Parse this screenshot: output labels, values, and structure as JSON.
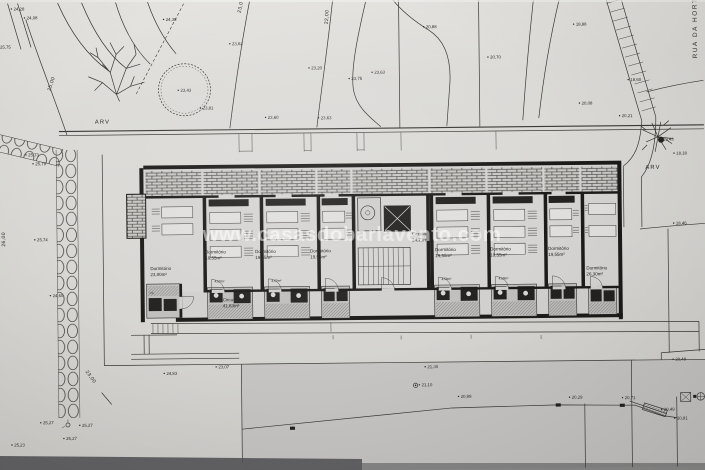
{
  "watermark": {
    "text": "www.casasdobarlavento.com"
  },
  "street": {
    "name": "RUA DA HORTINHA"
  },
  "trees": {
    "left_label": "ARV",
    "right_label": "ARV"
  },
  "colors": {
    "paper": "#dbdad7",
    "road": "#c6c5c3",
    "ink": "#3a3936",
    "wall": "#1c1b19",
    "watermark": "#ffffff"
  },
  "plan": {
    "rooms": [
      {
        "name": "Dormitório",
        "area": "23,80m²",
        "x": 150,
        "y": 268
      },
      {
        "name": "Dormitório",
        "area": "19,55m²",
        "x": 205,
        "y": 252
      },
      {
        "name": "Dormitório",
        "area": "19,55m²",
        "x": 255,
        "y": 252
      },
      {
        "name": "Dormitório",
        "area": "19,55m²",
        "x": 310,
        "y": 252
      },
      {
        "name": "Dormitório",
        "area": "19,55m²",
        "x": 435,
        "y": 252
      },
      {
        "name": "Dormitório",
        "area": "19,55m²",
        "x": 490,
        "y": 252
      },
      {
        "name": "Dormitório",
        "area": "19,55m²",
        "x": 548,
        "y": 252
      },
      {
        "name": "Dormitório",
        "area": "26,30m²",
        "x": 586,
        "y": 272
      },
      {
        "name": "Circulação",
        "area": "41,63m²",
        "x": 222,
        "y": 300
      },
      {
        "name": "Circulação",
        "area": "24,21m²",
        "x": 412,
        "y": 236
      }
    ],
    "bath_labels": [
      {
        "text": "4,50m²",
        "x": 214,
        "y": 281
      },
      {
        "text": "4,50m²",
        "x": 271,
        "y": 281
      },
      {
        "text": "4,50m²",
        "x": 441,
        "y": 281
      },
      {
        "text": "4,50m²",
        "x": 498,
        "y": 281
      },
      {
        "text": "I.S.",
        "x": 149,
        "y": 292
      }
    ],
    "spot_elevations": [
      {
        "text": "24,28",
        "x": 16,
        "y": 7
      },
      {
        "text": "24,08",
        "x": 29,
        "y": 16
      },
      {
        "text": "25,75",
        "x": 2,
        "y": 45
      },
      {
        "text": "24,38",
        "x": 168,
        "y": 19
      },
      {
        "text": "23,62",
        "x": 234,
        "y": 44
      },
      {
        "text": "23,43",
        "x": 182,
        "y": 90
      },
      {
        "text": "23,81",
        "x": 204,
        "y": 108
      },
      {
        "text": "23,60",
        "x": 269,
        "y": 118
      },
      {
        "text": "23,63",
        "x": 322,
        "y": 119
      },
      {
        "text": "23,20",
        "x": 313,
        "y": 69
      },
      {
        "text": "23,75",
        "x": 353,
        "y": 80
      },
      {
        "text": "23,63",
        "x": 376,
        "y": 74
      },
      {
        "text": "20,88",
        "x": 428,
        "y": 29
      },
      {
        "text": "18,88",
        "x": 578,
        "y": 28
      },
      {
        "text": "20,70",
        "x": 492,
        "y": 60
      },
      {
        "text": "20,08",
        "x": 583,
        "y": 107
      },
      {
        "text": "18,60",
        "x": 632,
        "y": 84
      },
      {
        "text": "20,21",
        "x": 623,
        "y": 120
      },
      {
        "text": "19,43",
        "x": 664,
        "y": 144
      },
      {
        "text": "18,18",
        "x": 677,
        "y": 158
      },
      {
        "text": "18,46",
        "x": 676,
        "y": 228
      },
      {
        "text": "25,73",
        "x": 29,
        "y": 153
      },
      {
        "text": "25,79",
        "x": 36,
        "y": 162
      },
      {
        "text": "25,74",
        "x": 37,
        "y": 238
      },
      {
        "text": "24,60",
        "x": 52,
        "y": 294
      },
      {
        "text": "24,83",
        "x": 165,
        "y": 373
      },
      {
        "text": "23,07",
        "x": 217,
        "y": 367
      },
      {
        "text": "21,30",
        "x": 426,
        "y": 369
      },
      {
        "text": "21,10",
        "x": 420,
        "y": 387
      },
      {
        "text": "20,98",
        "x": 459,
        "y": 399
      },
      {
        "text": "20,29",
        "x": 570,
        "y": 401
      },
      {
        "text": "20,71",
        "x": 623,
        "y": 402
      },
      {
        "text": "20,48",
        "x": 674,
        "y": 364
      },
      {
        "text": "20,49",
        "x": 662,
        "y": 414
      },
      {
        "text": "20,91",
        "x": 675,
        "y": 423
      },
      {
        "text": "25,27",
        "x": 41,
        "y": 421
      },
      {
        "text": "25,27",
        "x": 80,
        "y": 424
      },
      {
        "text": "25,27",
        "x": 64,
        "y": 437
      },
      {
        "text": "25,23",
        "x": 12,
        "y": 443
      }
    ],
    "contour_labels": [
      {
        "text": "25,00",
        "x": 52,
        "y": 88,
        "rot": -72
      },
      {
        "text": "23,0",
        "x": 243,
        "y": 12,
        "rot": -78
      },
      {
        "text": "22,00",
        "x": 330,
        "y": 24,
        "rot": -86
      },
      {
        "text": "26,00",
        "x": 5,
        "y": 243,
        "rot": -90
      },
      {
        "text": "23,00",
        "x": 84,
        "y": 369,
        "rot": 55
      }
    ]
  }
}
